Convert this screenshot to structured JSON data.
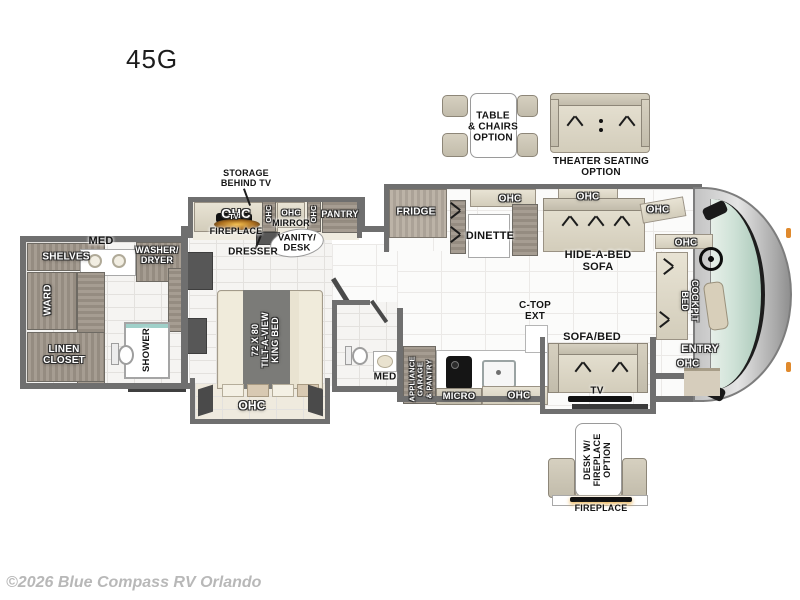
{
  "title": "45G",
  "watermark": "©2026 Blue Compass RV Orlando",
  "options": {
    "table_chairs": "TABLE\n& CHAIRS\nOPTION",
    "theater_seating": "THEATER SEATING\nOPTION",
    "desk_fireplace": "DESK W/\nFIREPLACE\nOPTION",
    "desk_fireplace_base": "FIREPLACE"
  },
  "labels": {
    "ohc": "OHC",
    "storage_behind_tv": "STORAGE\nBEHIND TV",
    "tv": "TV",
    "fireplace": "FIREPLACE",
    "pantry": "PANTRY",
    "mirror": "MIRROR",
    "vanity_desk": "VANITY/\nDESK",
    "dresser": "DRESSER",
    "fridge": "FRIDGE",
    "dinette": "DINETTE",
    "hide_a_bed_sofa": "HIDE-A-BED\nSOFA",
    "cockpit_bed": "COCKPIT\nBED",
    "entry": "ENTRY",
    "sofa_bed": "SOFA/BED",
    "c_top_ext": "C-TOP\nEXT",
    "micro": "MICRO",
    "appliance_garage": "APPLIANCE\nGARAGE\n& PANTRY",
    "med": "MED",
    "shelves": "SHELVES",
    "washer_dryer": "WASHER/\nDRYER",
    "ward": "WARD",
    "linen_closet": "LINEN\nCLOSET",
    "shower": "SHOWER",
    "king_bed": "72 X 80\nTILT-A-VIEW\nKING BED"
  },
  "colors": {
    "wall": "#6f6f6f",
    "wood": "#9d948a",
    "upholstery": "#ddd7c7",
    "windshield_glass": "#bdd6c9",
    "flame": "#e8a93c"
  }
}
